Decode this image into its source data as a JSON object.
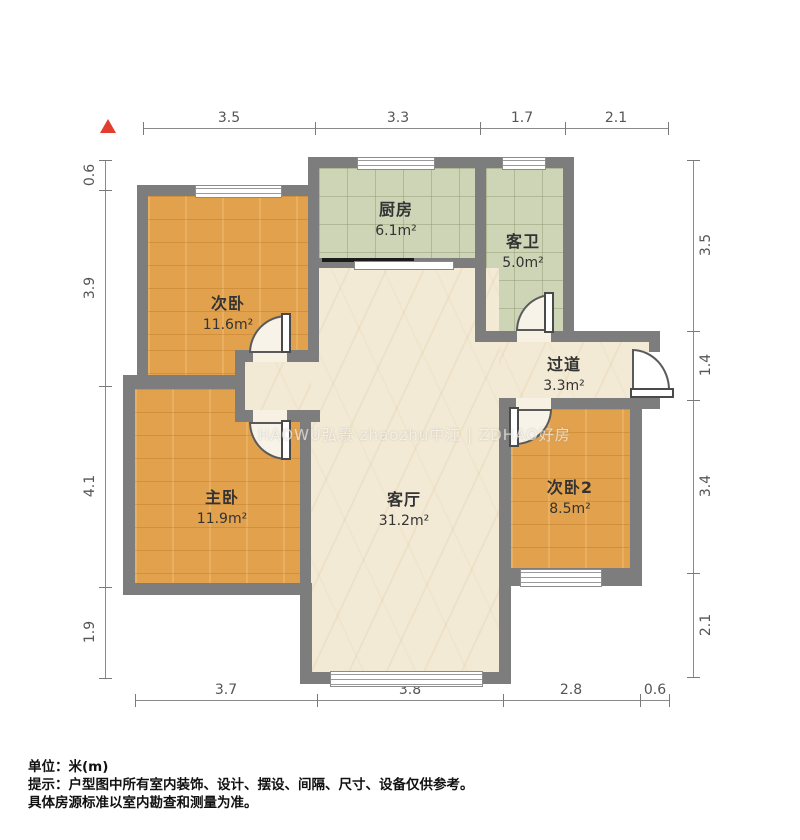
{
  "title": "户型图",
  "dimensions": {
    "top": [
      "3.5",
      "3.3",
      "1.7",
      "2.1"
    ],
    "bottom": [
      "3.7",
      "3.8",
      "2.8",
      "0.6"
    ],
    "left": [
      "0.6",
      "3.9",
      "4.1",
      "1.9"
    ],
    "right": [
      "3.5",
      "1.4",
      "3.4",
      "2.1"
    ]
  },
  "rooms": [
    {
      "name": "次卧",
      "area": "11.6m²"
    },
    {
      "name": "厨房",
      "area": "6.1m²"
    },
    {
      "name": "客卫",
      "area": "5.0m²"
    },
    {
      "name": "过道",
      "area": "3.3m²"
    },
    {
      "name": "主卧",
      "area": "11.9m²"
    },
    {
      "name": "客厅",
      "area": "31.2m²"
    },
    {
      "name": "次卧2",
      "area": "8.5m²"
    }
  ],
  "watermark": {
    "text": "HAOWU弘景·zhaozhu中江  |  ZDHAO好房"
  },
  "notes": {
    "unit": "单位：米(m)",
    "tip": "提示：户型图中所有室内装饰、设计、摆设、间隔、尺寸、设备仅供参考。",
    "tip2": "具体房源标准以室内勘查和测量为准。"
  },
  "colors": {
    "wall": "#7d7d7d",
    "wood_floor": "#e2a14d",
    "tile_floor": "#ced4b6",
    "marble_floor": "#f3ead6",
    "dimension_text": "#555555",
    "north_arrow": "#e23d2e",
    "note_text": "#111111"
  }
}
